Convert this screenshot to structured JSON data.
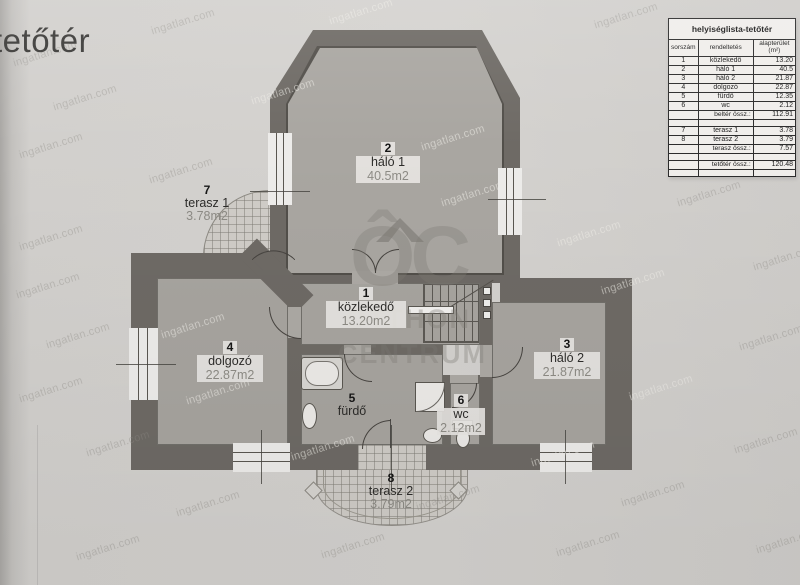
{
  "page": {
    "title": "tetőtér"
  },
  "brand": {
    "watermark": "ingatlan.com",
    "logo_monogram": "ÔC",
    "logo_word1": "OTTHON",
    "logo_word2": "CENTRUM"
  },
  "colors": {
    "paper": "#d2d0cd",
    "wall": "#6e6a65",
    "room_fill": "#a7a49f",
    "window": "#edecea",
    "area_text": "#8d8b85"
  },
  "rooms": {
    "halo1": {
      "num": "2",
      "name": "háló 1",
      "area": "40.5m2"
    },
    "kozlekedo": {
      "num": "1",
      "name": "közlekedő",
      "area": "13.20m2"
    },
    "dolgozo": {
      "num": "4",
      "name": "dolgozó",
      "area": "22.87m2"
    },
    "halo2": {
      "num": "3",
      "name": "háló 2",
      "area": "21.87m2"
    },
    "furdo": {
      "num": "5",
      "name": "fürdő",
      "area": ""
    },
    "wc": {
      "num": "6",
      "name": "wc",
      "area": "2.12m2"
    },
    "terasz1": {
      "num": "7",
      "name": "terasz 1",
      "area": "3.78m2"
    },
    "terasz2": {
      "num": "8",
      "name": "terasz 2",
      "area": "3.79m2"
    }
  },
  "table": {
    "title": "helyiséglista-tetőtér",
    "columns": {
      "num": "sorszám",
      "name": "rendeltetés",
      "area_line1": "alapterület",
      "area_line2": "(m²)"
    },
    "rows": [
      {
        "num": "1",
        "name": "közlekedő",
        "area": "13.20"
      },
      {
        "num": "2",
        "name": "háló 1",
        "area": "40.5"
      },
      {
        "num": "3",
        "name": "háló 2",
        "area": "21.87"
      },
      {
        "num": "4",
        "name": "dolgozó",
        "area": "22.87"
      },
      {
        "num": "5",
        "name": "fürdő",
        "area": "12.35"
      },
      {
        "num": "6",
        "name": "wc",
        "area": "2.12"
      },
      {
        "num": "",
        "name": "beltér össz.:",
        "area": "112.91"
      },
      {
        "num": "",
        "name": "",
        "area": ""
      },
      {
        "num": "7",
        "name": "terasz 1",
        "area": "3.78"
      },
      {
        "num": "8",
        "name": "terasz 2",
        "area": "3.79"
      },
      {
        "num": "",
        "name": "terasz össz.:",
        "area": "7.57"
      },
      {
        "num": "",
        "name": "",
        "area": ""
      },
      {
        "num": "",
        "name": "tetőtér össz.:",
        "area": "120.48"
      },
      {
        "num": "",
        "name": "",
        "area": ""
      }
    ]
  }
}
